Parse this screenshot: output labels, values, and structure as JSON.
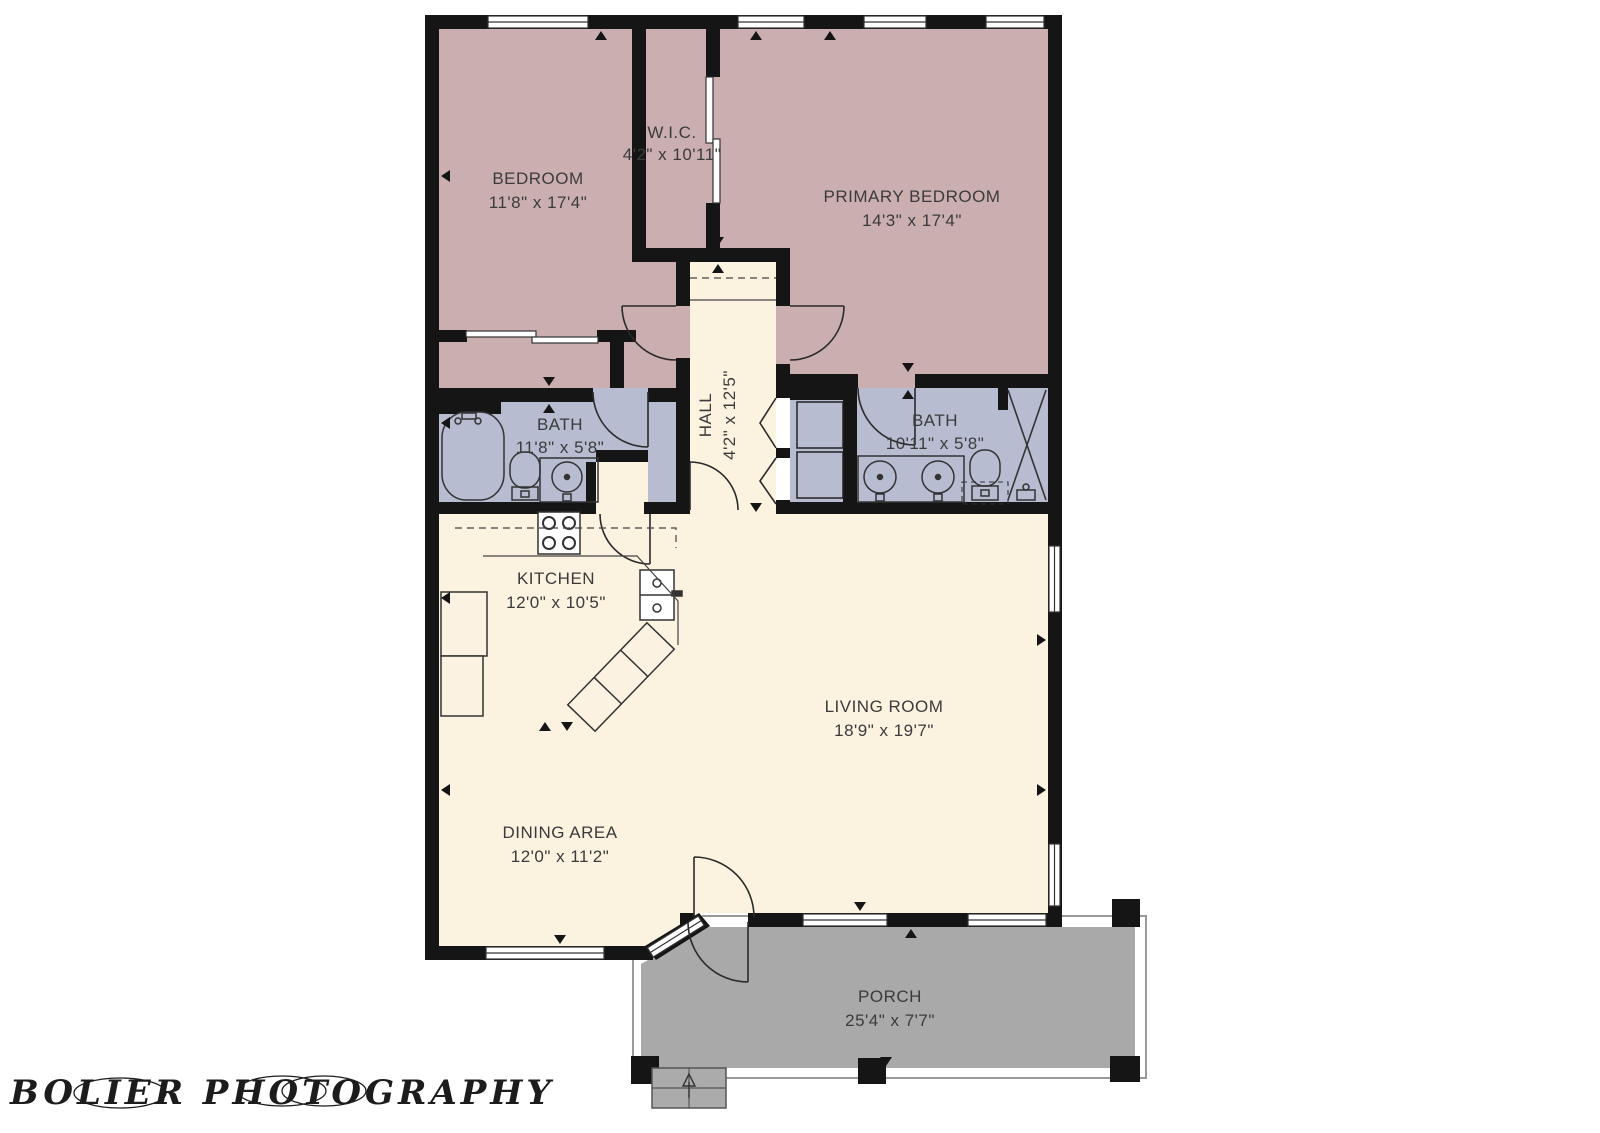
{
  "colors": {
    "wall": "#151515",
    "bedroom_fill": "#cbaeb0",
    "bath_fill": "#b7bcd1",
    "living_fill": "#fcf2e0",
    "porch_fill": "#a9a9a9",
    "fixture_fill": "#fbf2e2",
    "window_fill": "#ffffff",
    "line": "#333333",
    "trim": "#999999",
    "label": "#3b3b3b"
  },
  "rooms": [
    {
      "id": "bedroom",
      "name": "BEDROOM",
      "dims": "11'8\" x 17'4\""
    },
    {
      "id": "wic",
      "name": "W.I.C.",
      "dims": "4'2\" x 10'11\""
    },
    {
      "id": "primary-bedroom",
      "name": "PRIMARY BEDROOM",
      "dims": "14'3\" x 17'4\""
    },
    {
      "id": "bath-left",
      "name": "BATH",
      "dims": "11'8\" x 5'8\""
    },
    {
      "id": "hall",
      "name": "HALL",
      "dims": "4'2\" x 12'5\""
    },
    {
      "id": "bath-right",
      "name": "BATH",
      "dims": "10'11\" x 5'8\""
    },
    {
      "id": "kitchen",
      "name": "KITCHEN",
      "dims": "12'0\" x 10'5\""
    },
    {
      "id": "living-room",
      "name": "LIVING ROOM",
      "dims": "18'9\" x 19'7\""
    },
    {
      "id": "dining-area",
      "name": "DINING AREA",
      "dims": "12'0\" x 11'2\""
    },
    {
      "id": "porch",
      "name": "PORCH",
      "dims": "25'4\" x 7'7\""
    }
  ],
  "watermark": {
    "text": "BOLIER PHOTOGRAPHY"
  }
}
